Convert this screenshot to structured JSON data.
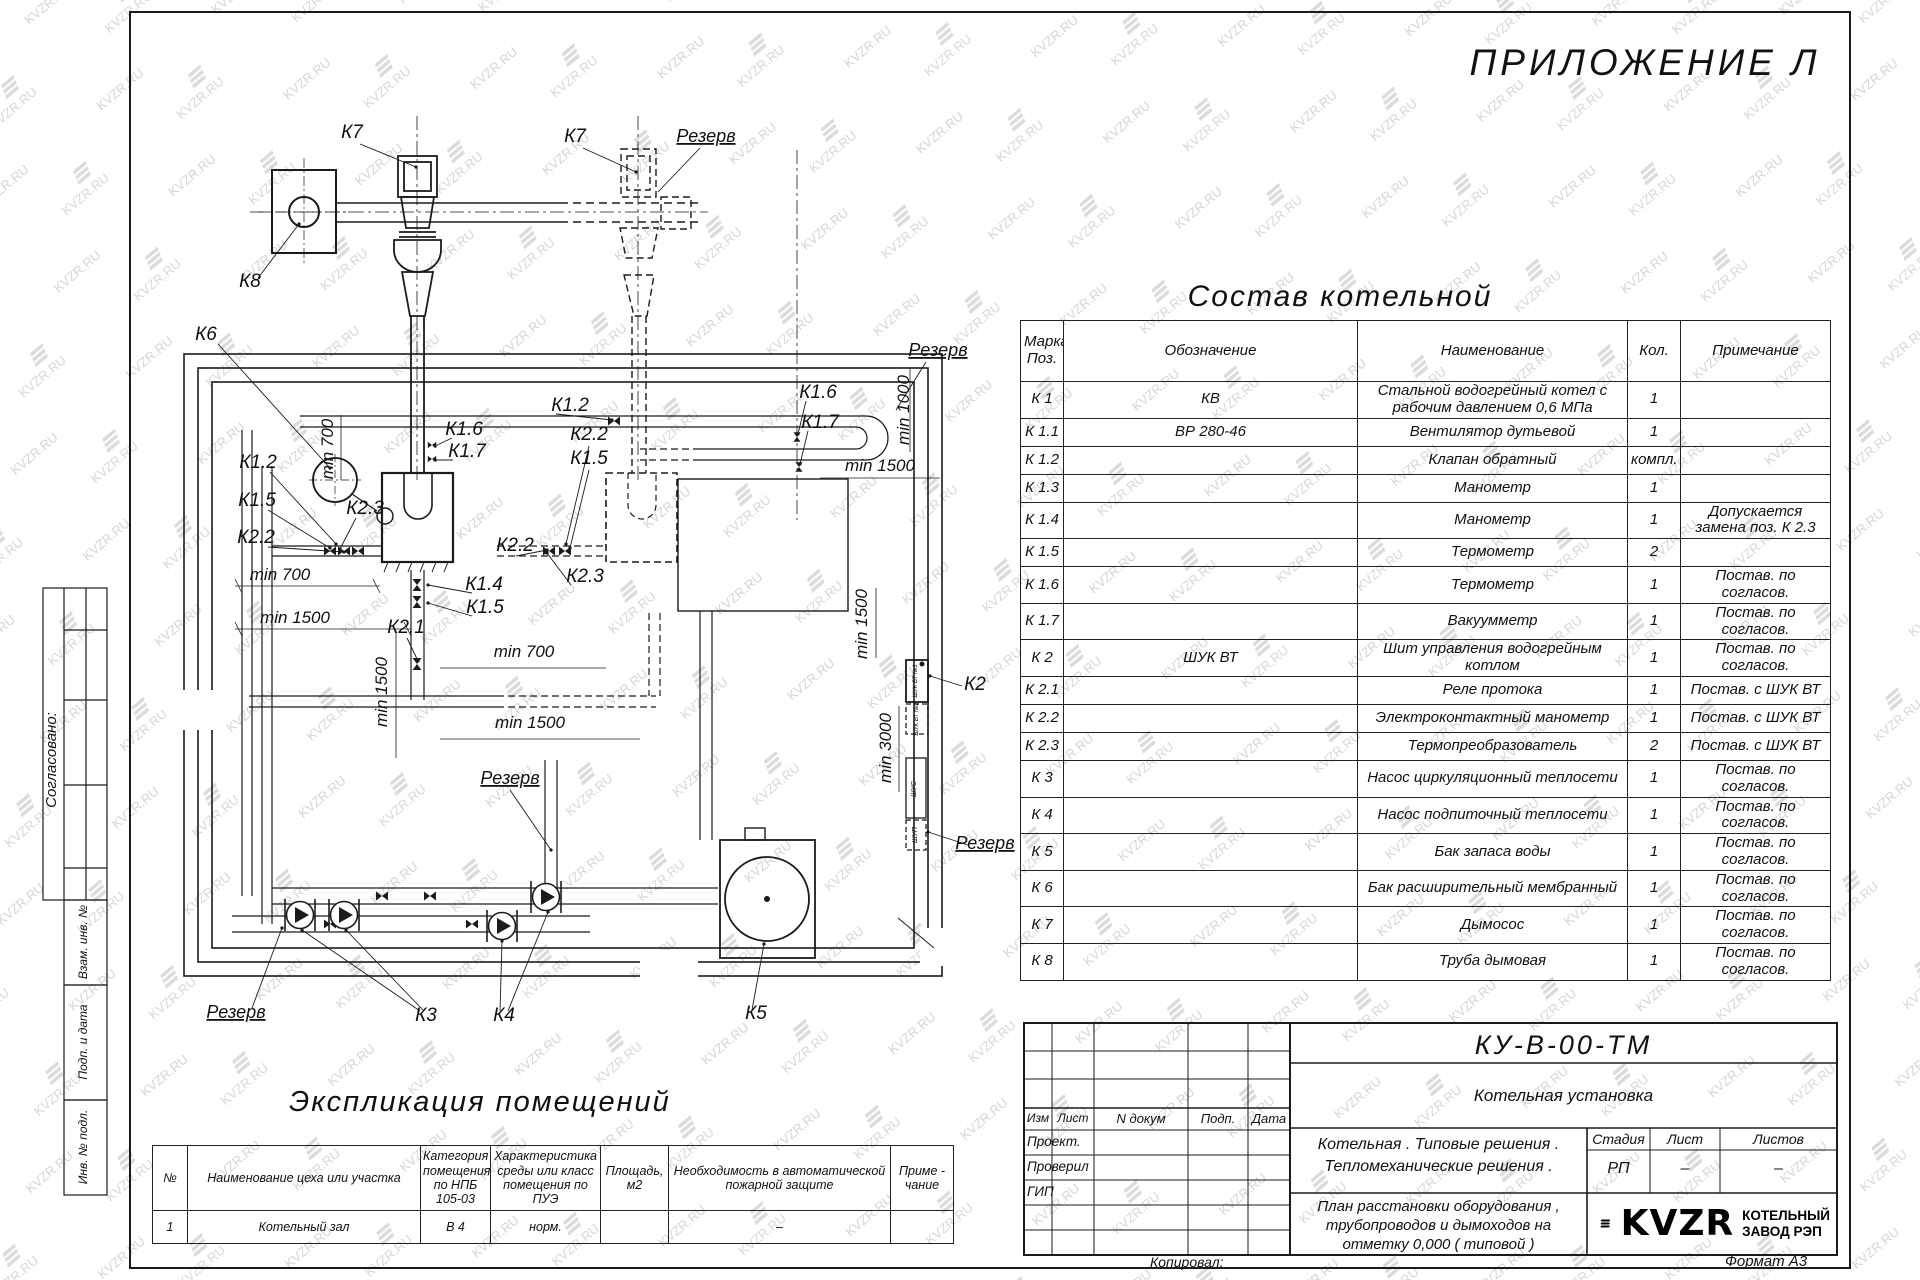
{
  "watermark": {
    "text": "KVZR.RU"
  },
  "appendix_title": "ПРИЛОЖЕНИЕ Л",
  "sostav": {
    "title": "Состав котельной",
    "headers": [
      "Марка Поз.",
      "Обозначение",
      "Наименование",
      "Кол.",
      "Примечание"
    ],
    "rows": [
      [
        "К 1",
        "КВ",
        "Стальной водогрейный котел с рабочим давлением 0,6 МПа",
        "1",
        ""
      ],
      [
        "К 1.1",
        "ВР 280-46",
        "Вентилятор дутьевой",
        "1",
        ""
      ],
      [
        "К 1.2",
        "",
        "Клапан обратный",
        "компл.",
        ""
      ],
      [
        "К 1.3",
        "",
        "Манометр",
        "1",
        ""
      ],
      [
        "К 1.4",
        "",
        "Манометр",
        "1",
        "Допускается замена поз. К 2.3"
      ],
      [
        "К 1.5",
        "",
        "Термометр",
        "2",
        ""
      ],
      [
        "К 1.6",
        "",
        "Термометр",
        "1",
        "Постав. по согласов."
      ],
      [
        "К 1.7",
        "",
        "Вакуумметр",
        "1",
        "Постав. по согласов."
      ],
      [
        "К 2",
        "ШУК ВТ",
        "Шит управления водогрейным котлом",
        "1",
        "Постав. по согласов."
      ],
      [
        "К 2.1",
        "",
        "Реле протока",
        "1",
        "Постав. с ШУК ВТ"
      ],
      [
        "К 2.2",
        "",
        "Электроконтактный манометр",
        "1",
        "Постав. с ШУК ВТ"
      ],
      [
        "К 2.3",
        "",
        "Термопреобразователь",
        "2",
        "Постав. с ШУК ВТ"
      ],
      [
        "К 3",
        "",
        "Насос циркуляционный теплосети",
        "1",
        "Постав. по согласов."
      ],
      [
        "К 4",
        "",
        "Насос подпиточный теплосети",
        "1",
        "Постав. по согласов."
      ],
      [
        "К 5",
        "",
        "Бак запаса воды",
        "1",
        "Постав. по согласов."
      ],
      [
        "К 6",
        "",
        "Бак расширительный мембранный",
        "1",
        "Постав. по согласов."
      ],
      [
        "К 7",
        "",
        "Дымосос",
        "1",
        "Постав. по согласов."
      ],
      [
        "К 8",
        "",
        "Труба дымовая",
        "1",
        "Постав. по согласов."
      ]
    ]
  },
  "explication": {
    "title": "Экспликация помещений",
    "headers": [
      "№",
      "Наименование цеха или участка",
      "Категория помещения по НПБ 105-03",
      "Характеристика среды или класс помещения по ПУЭ",
      "Площадь, м2",
      "Необходимость в автоматической пожарной защите",
      "Приме - чание"
    ],
    "rows": [
      [
        "1",
        "Котельный зал",
        "В 4",
        "норм.",
        "",
        "–",
        ""
      ]
    ]
  },
  "stamp": {
    "doc_code": "КУ-В-00-ТМ",
    "object_name": "Котельная установка",
    "project_line1": "Котельная . Типовые решения .",
    "project_line2": "Тепломеханические решения .",
    "sheet_line1": "План расстановки оборудования ,",
    "sheet_line2": "трубопроводов и дымоходов на",
    "sheet_line3": "отметку 0,000 ( типовой )",
    "col_izm": "Изм",
    "col_list": "Лист",
    "col_ndoc": "N докум",
    "col_podp": "Подп.",
    "col_data": "Дата",
    "role_1": "Проект.",
    "role_2": "Проверил",
    "role_3": "ГИП",
    "stage_h1": "Стадия",
    "stage_h2": "Лист",
    "stage_h3": "Листов",
    "stage_v1": "РП",
    "stage_v2": "–",
    "stage_v3": "–",
    "logo_text": "KVZR",
    "logo_sub1": "КОТЕЛЬНЫЙ",
    "logo_sub2": "ЗАВОД РЭП",
    "kopiroval": "Копировал:",
    "format": "Формат А3"
  },
  "margin": {
    "soglasovano": "Согласовано:",
    "vzam": "Взам. инв. №",
    "podp_data": "Подп. и дата",
    "inv_podl": "Инв. № подл."
  },
  "drawing": {
    "labels": [
      {
        "text": "К7",
        "x": 352,
        "y": 138
      },
      {
        "text": "К7",
        "x": 575,
        "y": 142
      },
      {
        "text": "Резерв",
        "x": 706,
        "y": 142,
        "fs": 18,
        "u": 1
      },
      {
        "text": "К8",
        "x": 250,
        "y": 287
      },
      {
        "text": "К6",
        "x": 206,
        "y": 340
      },
      {
        "text": "К1.2",
        "x": 258,
        "y": 468
      },
      {
        "text": "К1.5",
        "x": 257,
        "y": 506
      },
      {
        "text": "К2.2",
        "x": 256,
        "y": 543
      },
      {
        "text": "К2.3",
        "x": 365,
        "y": 514
      },
      {
        "text": "min 700",
        "x": 333,
        "y": 449,
        "rot": -90,
        "fs": 17
      },
      {
        "text": "min 700",
        "x": 280,
        "y": 580,
        "fs": 17
      },
      {
        "text": "min 1500",
        "x": 295,
        "y": 623,
        "fs": 17
      },
      {
        "text": "К2.1",
        "x": 406,
        "y": 633
      },
      {
        "text": "min 1500",
        "x": 387,
        "y": 692,
        "rot": -90,
        "fs": 17
      },
      {
        "text": "К1.4",
        "x": 484,
        "y": 590
      },
      {
        "text": "К1.5",
        "x": 485,
        "y": 613
      },
      {
        "text": "К1.6",
        "x": 464,
        "y": 435
      },
      {
        "text": "К1.7",
        "x": 467,
        "y": 457
      },
      {
        "text": "К1.2",
        "x": 570,
        "y": 411
      },
      {
        "text": "К2.2",
        "x": 515,
        "y": 551
      },
      {
        "text": "К2.2",
        "x": 589,
        "y": 440
      },
      {
        "text": "К1.5",
        "x": 589,
        "y": 464
      },
      {
        "text": "К2.3",
        "x": 585,
        "y": 582
      },
      {
        "text": "min 700",
        "x": 524,
        "y": 657,
        "fs": 17
      },
      {
        "text": "min 1500",
        "x": 530,
        "y": 728,
        "fs": 17
      },
      {
        "text": "К1.6",
        "x": 818,
        "y": 398
      },
      {
        "text": "К1.7",
        "x": 820,
        "y": 428
      },
      {
        "text": "Резерв",
        "x": 938,
        "y": 356,
        "fs": 18,
        "u": 1
      },
      {
        "text": "min 1500",
        "x": 880,
        "y": 471,
        "fs": 17
      },
      {
        "text": "min 1000",
        "x": 909,
        "y": 410,
        "rot": -90,
        "fs": 17
      },
      {
        "text": "min 1500",
        "x": 867,
        "y": 624,
        "rot": -90,
        "fs": 17
      },
      {
        "text": "min 3000",
        "x": 891,
        "y": 748,
        "rot": -90,
        "fs": 17
      },
      {
        "text": "К2",
        "x": 975,
        "y": 690
      },
      {
        "text": "Резерв",
        "x": 985,
        "y": 849,
        "fs": 18,
        "u": 1
      },
      {
        "text": "Резерв",
        "x": 510,
        "y": 784,
        "fs": 18,
        "u": 1
      },
      {
        "text": "Резерв",
        "x": 236,
        "y": 1018,
        "fs": 18,
        "u": 1
      },
      {
        "text": "К3",
        "x": 426,
        "y": 1021
      },
      {
        "text": "К4",
        "x": 504,
        "y": 1021
      },
      {
        "text": "К5",
        "x": 756,
        "y": 1019
      },
      {
        "text": "ШУК ВТ №1",
        "x": 917,
        "y": 681,
        "rot": -90,
        "fs": 6
      },
      {
        "text": "ШУК ВТ №2",
        "x": 918,
        "y": 719,
        "rot": -90,
        "fs": 6
      },
      {
        "text": "ШУС",
        "x": 916,
        "y": 789,
        "rot": -90,
        "fs": 7
      },
      {
        "text": "ШУП",
        "x": 917,
        "y": 835,
        "rot": -90,
        "fs": 7
      }
    ]
  }
}
